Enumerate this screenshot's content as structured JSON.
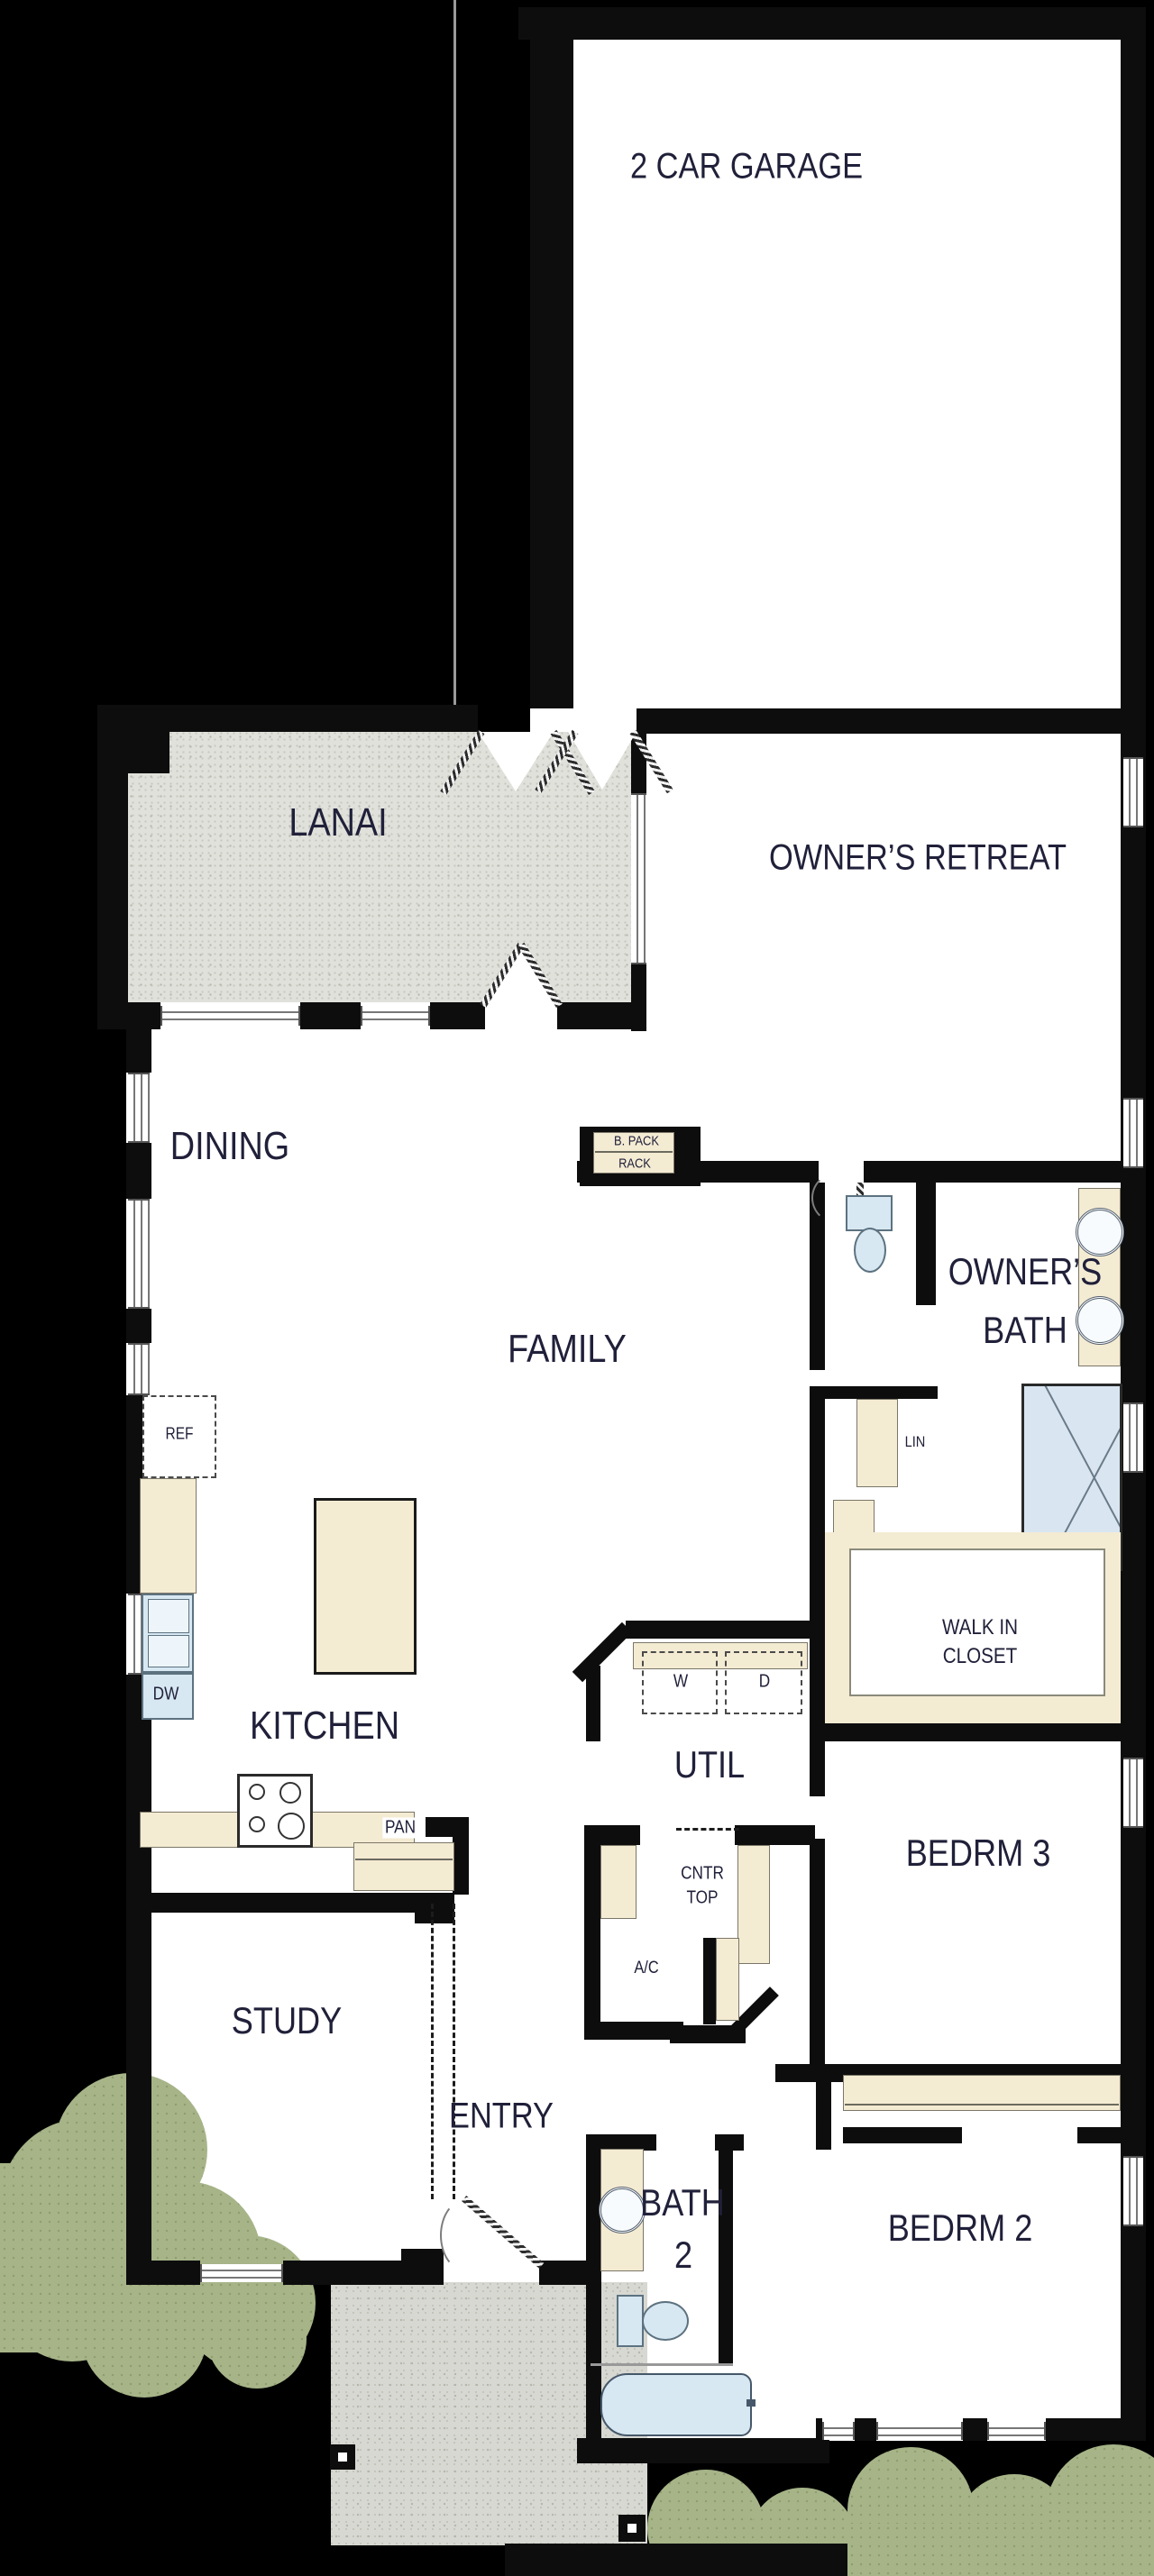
{
  "plan": {
    "type": "residential-floor-plan",
    "rooms": {
      "garage": {
        "label": "2 CAR GARAGE"
      },
      "lanai": {
        "label": "LANAI"
      },
      "owners_retreat": {
        "label": "OWNER’S RETREAT"
      },
      "dining": {
        "label": "DINING"
      },
      "family": {
        "label": "FAMILY"
      },
      "owners_bath": {
        "line1": "OWNER’S",
        "line2": "BATH"
      },
      "walk_in_closet": {
        "line1": "WALK IN",
        "line2": "CLOSET"
      },
      "kitchen": {
        "label": "KITCHEN"
      },
      "util": {
        "label": "UTIL"
      },
      "bedroom3": {
        "label": "BEDRM 3"
      },
      "bedroom2": {
        "label": "BEDRM 2"
      },
      "bath2": {
        "line1": "BATH",
        "line2": "2"
      },
      "study": {
        "label": "STUDY"
      },
      "entry": {
        "label": "ENTRY"
      }
    },
    "fixtures": {
      "ref": "REF",
      "dw": "DW",
      "pan": "PAN",
      "washer": "W",
      "dryer": "D",
      "cntr_top": {
        "line1": "CNTR",
        "line2": "TOP"
      },
      "ac": "A/C",
      "lin": "LIN",
      "backpack_rack": {
        "line1": "B. PACK",
        "line2": "RACK"
      }
    },
    "colors": {
      "background": "#000000",
      "wall": "#0d0d0d",
      "floor_white": "#ffffff",
      "counter_tan": "#f4ebd3",
      "fixture_blue": "#d7e8f2",
      "shower_blue": "#d9e6f1",
      "lanai_gray": "#e0e1db",
      "porch_gray": "#d7d8d2",
      "grass_green": "#a6b488",
      "text": "#20203a",
      "window_line": "#777777"
    }
  }
}
